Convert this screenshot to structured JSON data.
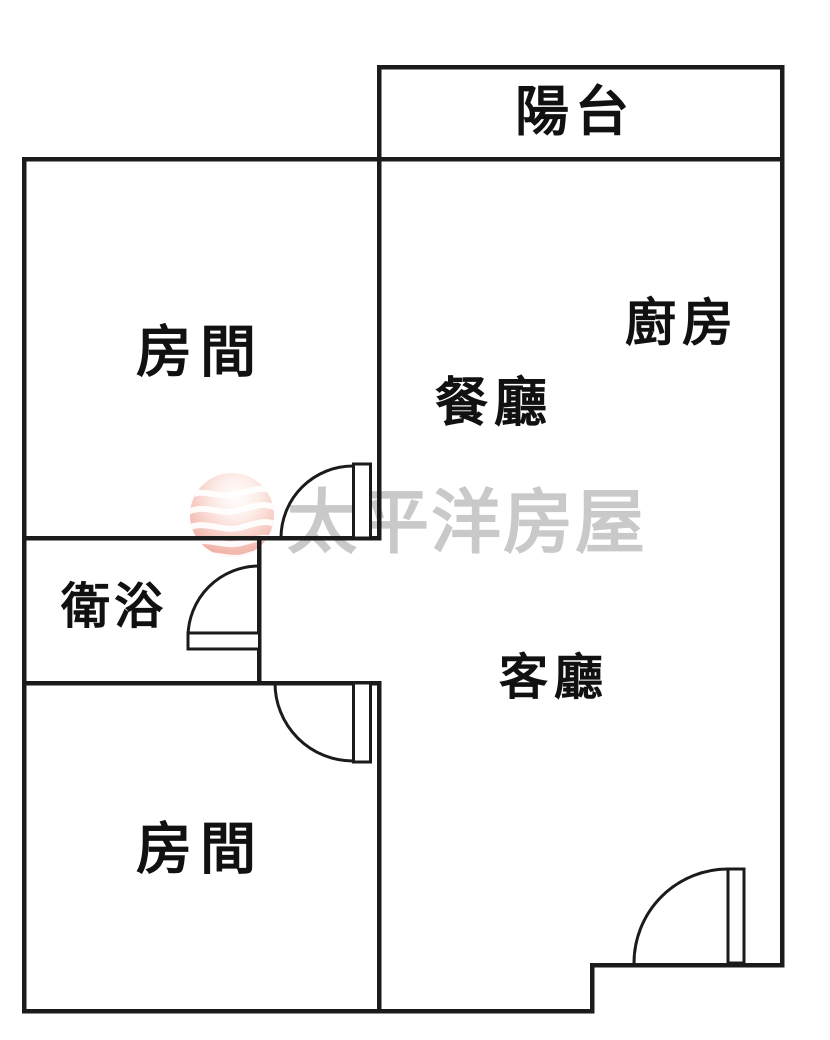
{
  "colors": {
    "background": "#ffffff",
    "wall": "#1b1b1b",
    "label": "#111111",
    "watermark_text": "#c9c9c9",
    "logo_pink_edge": "#eeab9f",
    "logo_pink_mid": "#f7cfc7",
    "logo_highlight": "#fffefe",
    "logo_wave": "#ffffff"
  },
  "plan": {
    "labels": {
      "balcony": "陽台",
      "kitchen": "廚房",
      "dining": "餐廳",
      "living": "客廳",
      "bathroom": "衛浴",
      "bedroom_top": "房間",
      "bedroom_bottom": "房間"
    },
    "watermark": {
      "brand": "太平洋房屋"
    }
  }
}
